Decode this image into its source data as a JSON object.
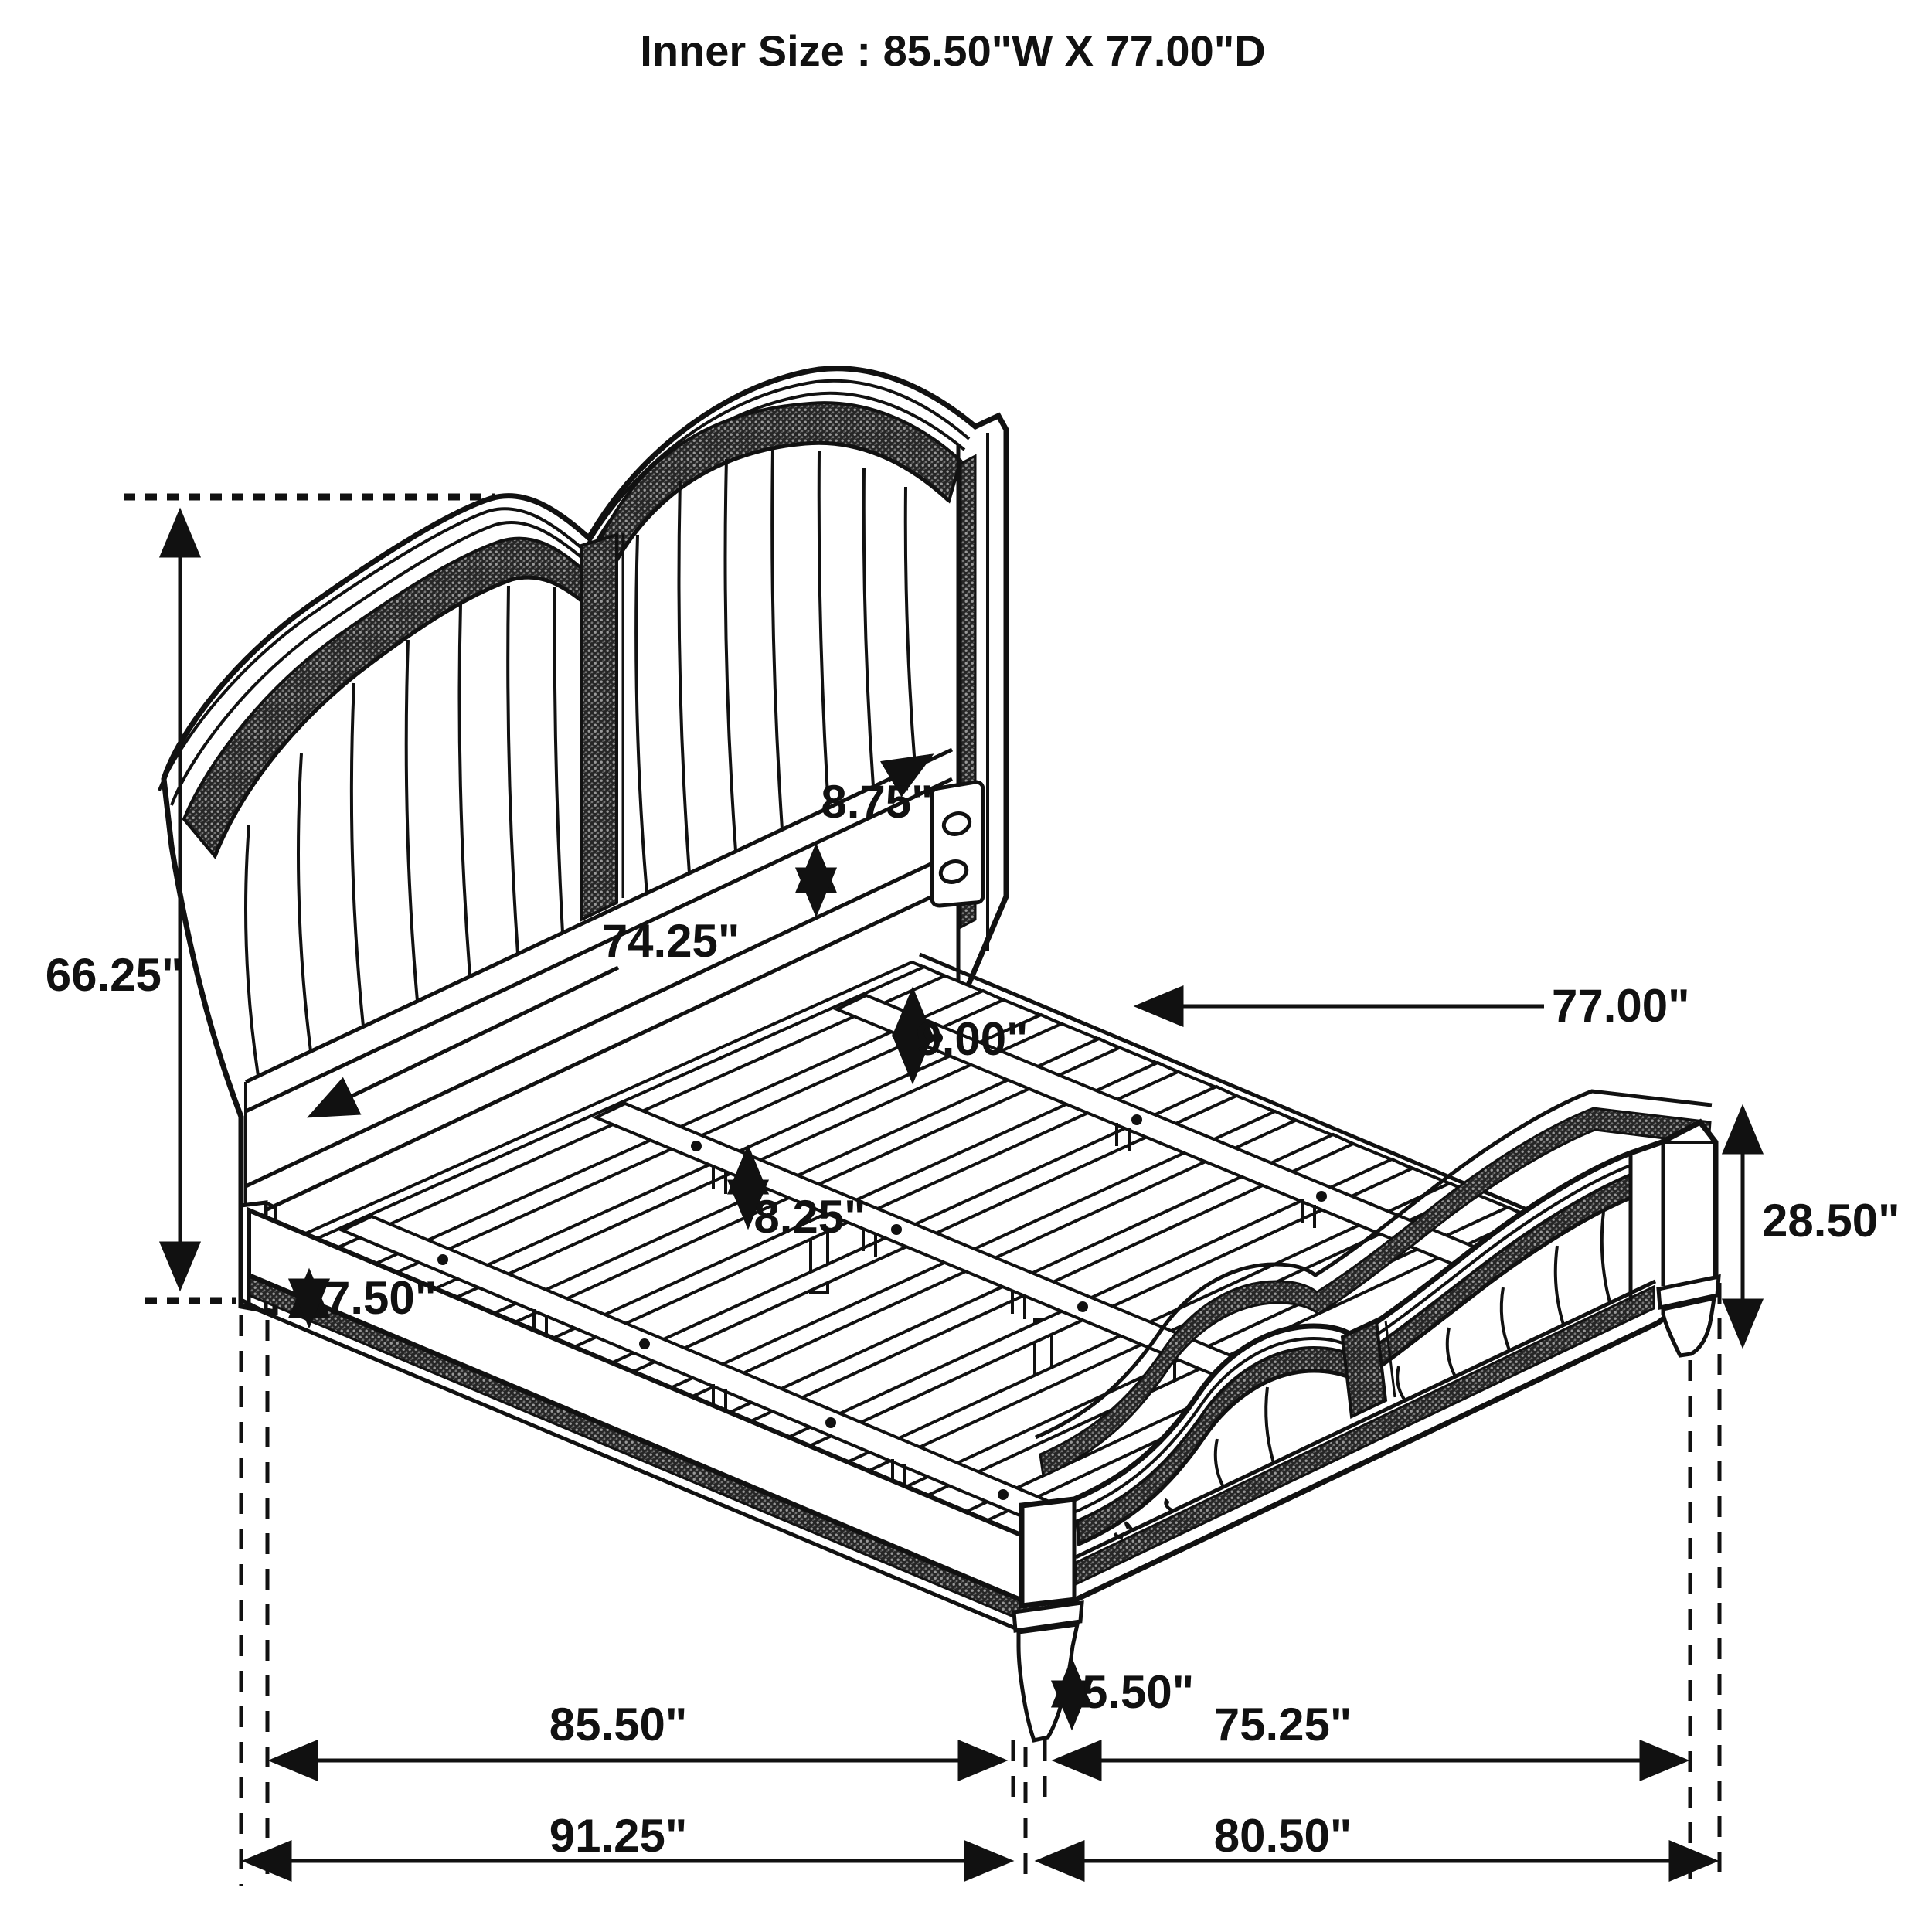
{
  "title": "Inner Size : 85.50\"W X 77.00\"D",
  "diagram": "bed-frame-dimension-drawing",
  "dimensions": {
    "headboard_height": "66.25\"",
    "rail_floor_clearance": "7.50\"",
    "headboard_panel_gap": "8.75\"",
    "inner_rail_length": "74.25\"",
    "slat_spacing_a": "9.00\"",
    "slat_spacing_b": "8.25\"",
    "slat_length_depth": "77.00\"",
    "footboard_height": "28.50\"",
    "footboard_leg_height": "5.50\"",
    "inner_width": "85.50\"",
    "footboard_inner_width": "75.25\"",
    "outer_length": "91.25\"",
    "footboard_outer_width": "80.50\""
  }
}
